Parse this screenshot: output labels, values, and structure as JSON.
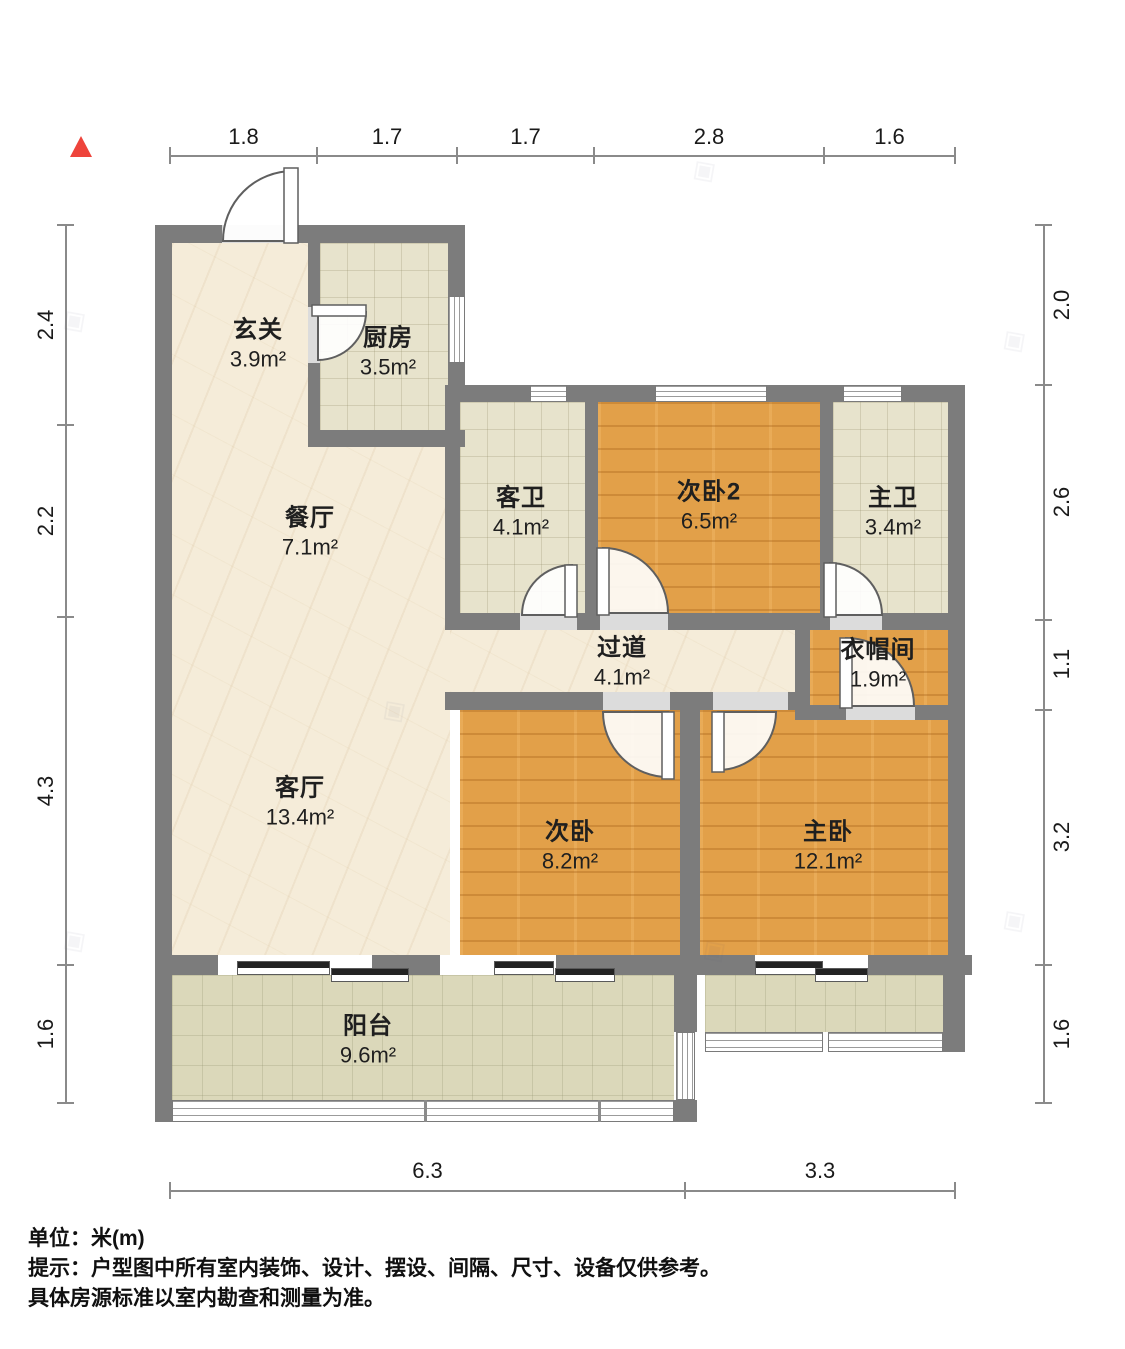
{
  "icons": {
    "north_indicator": "red-triangle-up",
    "watermark_symbol": "◈"
  },
  "dimensions": {
    "top": [
      "1.8",
      "1.7",
      "1.7",
      "2.8",
      "1.6"
    ],
    "left": [
      "2.4",
      "2.2",
      "4.3",
      "1.6"
    ],
    "right": [
      "2.0",
      "2.6",
      "1.1",
      "3.2",
      "1.6"
    ],
    "bottom": [
      "6.3",
      "3.3"
    ]
  },
  "rooms": [
    {
      "id": "entry",
      "name": "玄关",
      "area": "3.9m²"
    },
    {
      "id": "kitchen",
      "name": "厨房",
      "area": "3.5m²"
    },
    {
      "id": "dining",
      "name": "餐厅",
      "area": "7.1m²"
    },
    {
      "id": "guest-bath",
      "name": "客卫",
      "area": "4.1m²"
    },
    {
      "id": "bedroom2",
      "name": "次卧2",
      "area": "6.5m²"
    },
    {
      "id": "master-bath",
      "name": "主卫",
      "area": "3.4m²"
    },
    {
      "id": "hallway",
      "name": "过道",
      "area": "4.1m²"
    },
    {
      "id": "closet",
      "name": "衣帽间",
      "area": "1.9m²"
    },
    {
      "id": "living",
      "name": "客厅",
      "area": "13.4m²"
    },
    {
      "id": "bedroom",
      "name": "次卧",
      "area": "8.2m²"
    },
    {
      "id": "master-bed",
      "name": "主卧",
      "area": "12.1m²"
    },
    {
      "id": "balcony",
      "name": "阳台",
      "area": "9.6m²"
    }
  ],
  "footer": {
    "unit_note": "单位：米(m)",
    "tip_line1": "提示：户型图中所有室内装饰、设计、摆设、间隔、尺寸、设备仅供参考。",
    "tip_line2": "具体房源标准以室内勘查和测量为准。"
  },
  "colors": {
    "wall": "#7c7c7c",
    "wood_floor": "#e2a049",
    "tile_floor": "#e7e3cc",
    "balcony_floor": "#dbd8ba",
    "marble_floor": "#f5ecd9",
    "north_red": "#ee443b",
    "dimension_line": "#8a8a8a"
  }
}
